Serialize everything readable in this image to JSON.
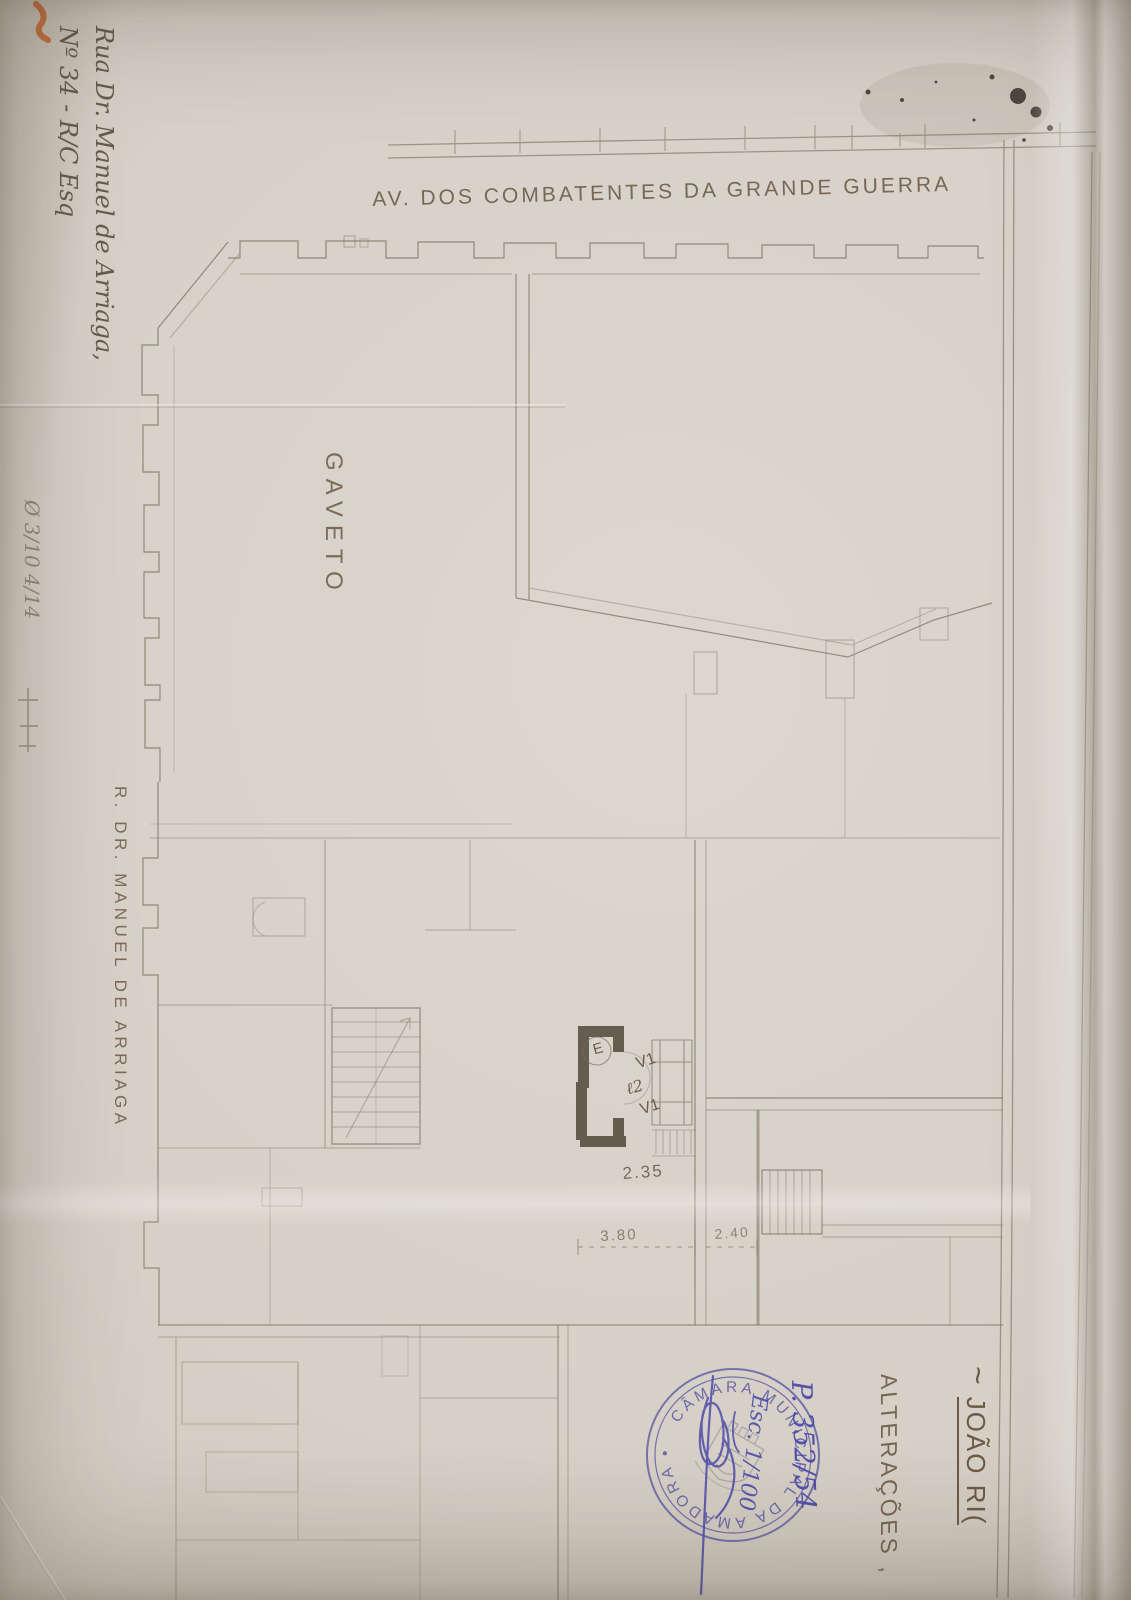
{
  "document": {
    "type": "Scanned architectural floor plan of a corner building (ground floor), hand-drawn, with municipal approval stamp",
    "orientation_note": "drawing and most lettering rotated 90 degrees on the page"
  },
  "colors": {
    "paper": "#d6d0c7",
    "drawing_ink": "#776a58",
    "thick_wall": "#4c4336",
    "pencil": "#655b4e",
    "pen_blue": "#4645a6",
    "stamp_blue": "#5a58a2",
    "orange_mark": "#c4622c"
  },
  "labels": {
    "street_top": "AV. DOS COMBATENTES DA GRANDE GUERRA",
    "street_left": "R. DR. MANUEL DE ARRIAGA",
    "corner": "GAVETO",
    "alterations": "ALTERAÇÕES ,",
    "owner_prefix": "~",
    "owner_name": "JOÃO RI(",
    "address_line1": "Rua Dr. Manuel de Arriaga,",
    "address_line2": "Nº 34 - R/C Esq",
    "margin_note": "Ø 3/10 4/14"
  },
  "dimensions": {
    "hall_width": "2.35",
    "left_bay": "3.80",
    "right_bay": "2.40"
  },
  "plan_marks": {
    "window_upper": "V1",
    "door_code": "ℓ2",
    "window_lower": "V1",
    "entrance": "E"
  },
  "stamp": {
    "ring_text": "CÂMARA MUNICIPAL DA AMADORA •",
    "process_number": "P. 352/54",
    "scale_note": "Esc. 1/100"
  }
}
